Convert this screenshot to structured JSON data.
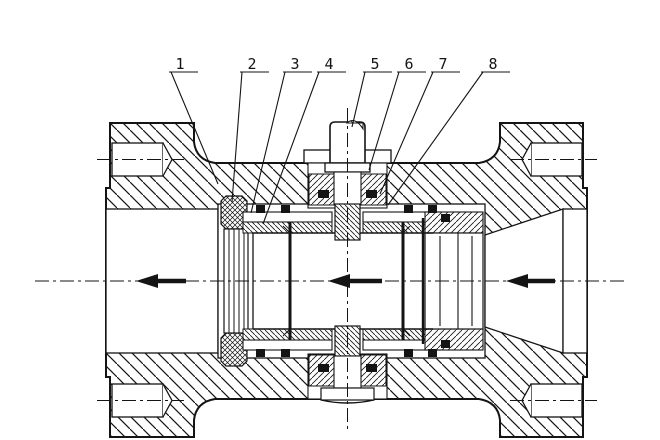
{
  "figure": {
    "kind": "ball-valve-sectional-drawing",
    "background_color": "#ffffff",
    "line_color": "#141414",
    "seal_color": "#141414"
  },
  "callouts": [
    {
      "label": "1"
    },
    {
      "label": "2"
    },
    {
      "label": "3"
    },
    {
      "label": "4"
    },
    {
      "label": "5"
    },
    {
      "label": "6"
    },
    {
      "label": "7"
    },
    {
      "label": "8"
    }
  ],
  "flow": {
    "direction": "left",
    "arrow_count": 3
  }
}
